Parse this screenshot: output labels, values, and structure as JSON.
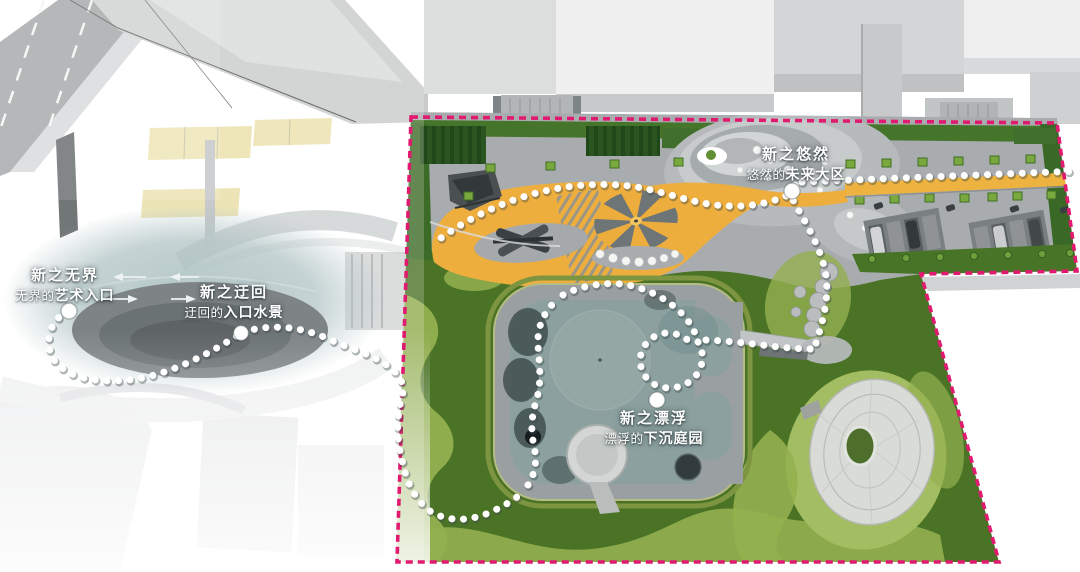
{
  "annotations": [
    {
      "id": "wujie",
      "title": "新之无界",
      "sub_prefix": "无界的",
      "sub_emphasis": "艺术入口"
    },
    {
      "id": "yuhui",
      "title": "新之迂回",
      "sub_prefix": "迂回的",
      "sub_emphasis": "入口水景"
    },
    {
      "id": "youran",
      "title": "新之悠然",
      "sub_prefix": "悠然的",
      "sub_emphasis": "未来大区"
    },
    {
      "id": "piaofu",
      "title": "新之漂浮",
      "sub_prefix": "漂浮的",
      "sub_emphasis": "下沉庭园"
    }
  ],
  "icons": {
    "arrow-left": "←",
    "arrow-right": "→",
    "trail-dot": "●"
  },
  "colors": {
    "boundary_pink": "#E01A6F",
    "lawn_dark": "#4A7326",
    "lawn_light": "#93B050",
    "path_yellow": "#EEAE3E",
    "plaza_gray": "#A9ACAE",
    "pool_water": "#8BA09F",
    "trail_white": "#FFFFFF"
  }
}
